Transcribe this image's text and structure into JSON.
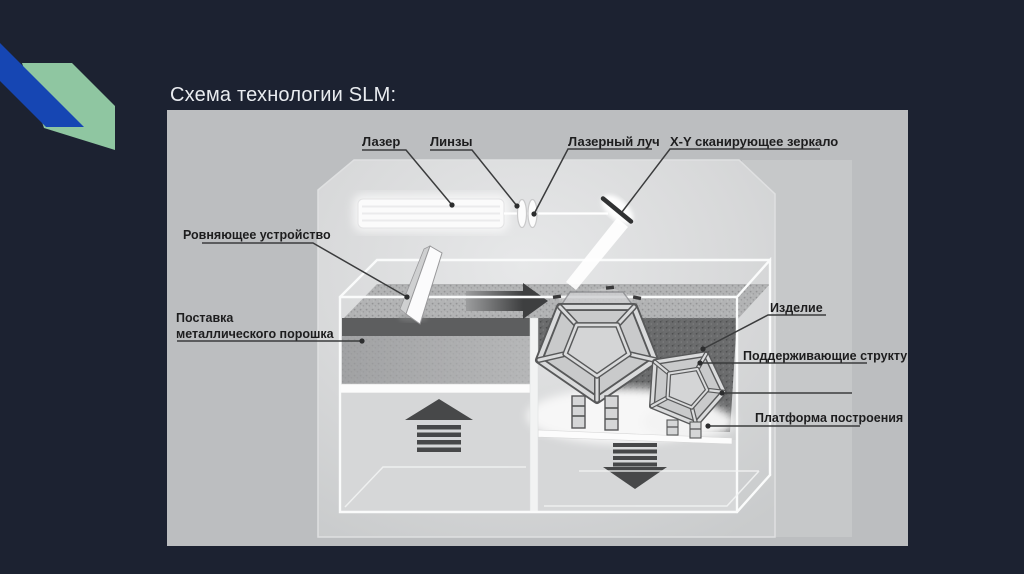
{
  "slide": {
    "title": "Схема технологии SLM:",
    "background_color": "#1c2231",
    "title_color": "#e9ecf0",
    "decor": {
      "blue_ribbon_color": "#1646b3",
      "green_ribbon_color": "#8fc6a1"
    }
  },
  "diagram": {
    "type": "schematic",
    "subject": "SLM (Selective Laser Melting) machine schematic",
    "colors": {
      "outer_background": "#bcbec0",
      "machine_body": "#d0d2d3",
      "powder_light": "#b2b3b4",
      "powder_dark": "#6b6c6d",
      "arrow": "#474849",
      "label_text": "#1d1d1e",
      "chamber_lines": "#fafbfb"
    },
    "labels": {
      "laser": "Лазер",
      "lenses": "Линзы",
      "laser_beam": "Лазерный луч",
      "xy_mirror": "X-Y сканирующее зеркало",
      "leveler": "Ровняющее устройство",
      "powder_supply_line1": "Поставка",
      "powder_supply_line2": "металлического порошка",
      "product": "Изделие",
      "supports": "Поддерживающие структуры",
      "platform": "Платформа построения"
    }
  }
}
